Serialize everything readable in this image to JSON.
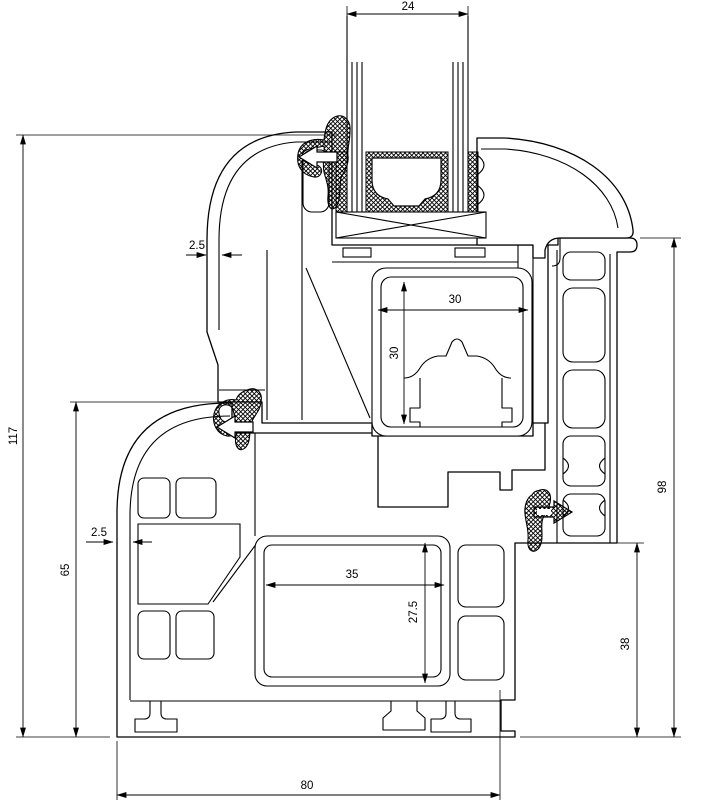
{
  "dimensions": {
    "glass_thickness": {
      "value": "24"
    },
    "sash_wall_thickness": {
      "value": "2.5"
    },
    "sash_steel_width": {
      "value": "30"
    },
    "sash_steel_height": {
      "value": "30"
    },
    "total_height": {
      "value": "117"
    },
    "frame_height_left": {
      "value": "65"
    },
    "frame_wall_thickness": {
      "value": "2.5"
    },
    "frame_steel_width": {
      "value": "35"
    },
    "frame_steel_height": {
      "value": "27.5"
    },
    "frame_height_right": {
      "value": "98"
    },
    "frame_lower_height": {
      "value": "38"
    },
    "frame_depth": {
      "value": "80"
    }
  },
  "style": {
    "line_color": "#000000",
    "background": "#ffffff",
    "seal_fill": "cross-hatch"
  }
}
